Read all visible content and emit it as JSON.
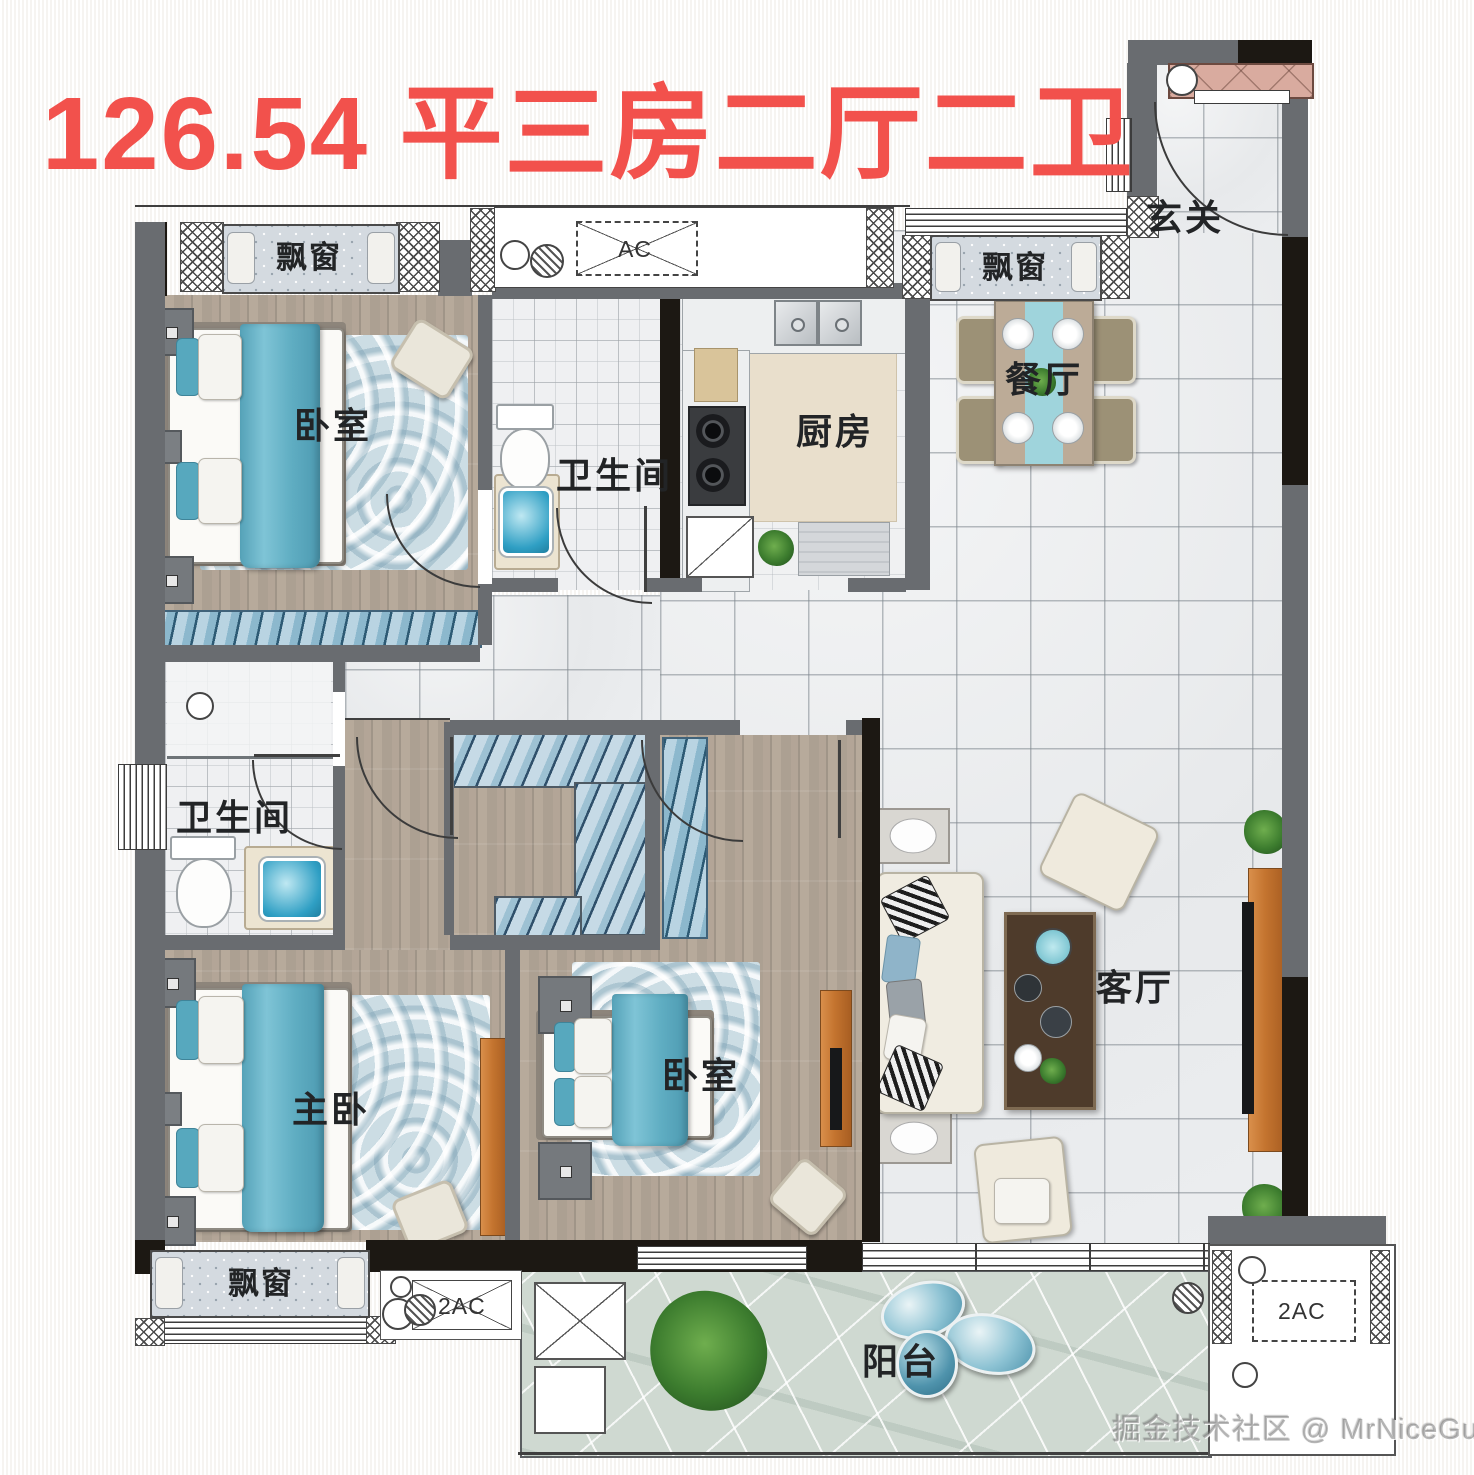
{
  "title": {
    "text": "126.54 平三房二厅二卫"
  },
  "rooms": {
    "bedroom_top_left": "卧室",
    "bath_top": "卫生间",
    "kitchen": "厨房",
    "dining": "餐厅",
    "entry": "玄关",
    "bath_left": "卫生间",
    "master_bedroom": "主卧",
    "bedroom_mid": "卧室",
    "living": "客厅",
    "balcony": "阳台"
  },
  "windows": {
    "bay_top_left": "飘窗",
    "bay_top_right": "飘窗",
    "bay_bottom_left": "飘窗"
  },
  "ac_units": {
    "top": "AC",
    "bottom_left": "2AC",
    "bottom_right": "2AC"
  },
  "watermark": {
    "text": "掘金技术社区 @ MrNiceGuy"
  },
  "colors": {
    "title_red": "#f2514c",
    "accent_teal": "#5fadc2",
    "wall_gray": "#696c70",
    "wall_dark": "#1c1813",
    "wood_floor": "#afa294",
    "tile_floor": "#eaeced",
    "stone_floor": "#cfd9d1",
    "wardrobe_orange": "#c4742f",
    "cabinet_pink": "#d9ab9f"
  }
}
